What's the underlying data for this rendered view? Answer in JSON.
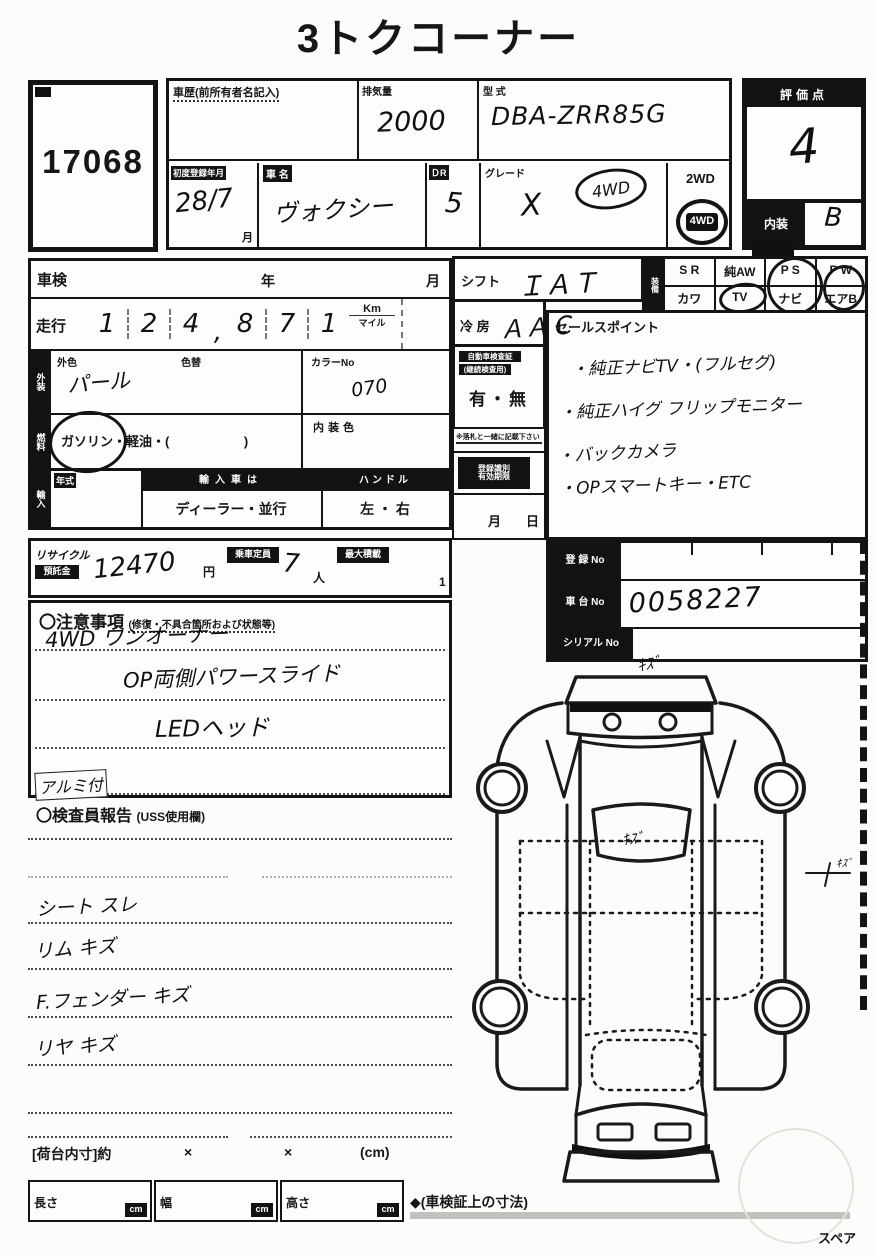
{
  "title": "3トクコーナー",
  "lot_number": "17068",
  "header": {
    "history_label": "車歴(前所有者名記入)",
    "disp_label": "排気量",
    "disp_value": "2000",
    "model_label": "型 式",
    "model_value": "DBA-ZRR85G",
    "reg_label": "初度登録年月",
    "reg_value": "28/7",
    "reg_unit": "月",
    "name_label": "車 名",
    "name_value": "ヴォクシー",
    "door_label": "ＤR",
    "door_value": "5",
    "grade_label": "グレード",
    "grade_value": "X",
    "grade_note": "4WD",
    "drive_2wd": "2WD",
    "drive_4wd": "4WD",
    "score_label": "評価点",
    "score_value": "4",
    "interior_label": "内装",
    "interior_value": "B"
  },
  "left": {
    "shaken": "車検",
    "year": "年",
    "month": "月",
    "mileage_label": "走行",
    "digits": [
      "1",
      "2",
      "4",
      ",",
      "8",
      "7",
      "1"
    ],
    "km": "Km",
    "mile": "マイル",
    "color_chip": "外装",
    "color_label": "外色",
    "color_value": "パール",
    "color_change": "色替",
    "colorno_label": "カラーNo",
    "colorno_value": "070",
    "fuel_chip": "燃料",
    "fuel_1": "ガソリン",
    "fuel_2": "・軽油・(",
    "fuel_3": ")",
    "intcolor_label": "内装色",
    "import_chip": "輸入",
    "year_label": "年式",
    "import_label": "輸入車は",
    "import_value": "ディーラー・並行",
    "handle_label": "ハンドル",
    "handle_value": "左 ・ 右"
  },
  "middle": {
    "shift_label": "シフト",
    "shift_value": "ＩＡＴ",
    "ac_label": "冷 房",
    "ac_value": "ＡＡＣ",
    "docs_chip1": "自動車検査証",
    "docs_chip2": "(継続検査用)",
    "docs_value": "有・無",
    "note": "※落札と一緒に記載下さい",
    "regbox1": "登録識別",
    "regbox2": "有効期限",
    "month": "月",
    "day": "日"
  },
  "equipment": {
    "side": "装備",
    "cols": [
      "S R",
      "純AW",
      "P S",
      "P W"
    ],
    "row2": [
      "カワ",
      "TV",
      "ナビ",
      "エアB"
    ]
  },
  "sales": {
    "label": "セールスポイント",
    "lines": [
      "・純正ナビTV・(フルセグ)",
      "・純正ハイグ フリップモニター",
      "・バックカメラ",
      "・OPスマートキー・ETC"
    ]
  },
  "reg": {
    "no_label": "登 録 No",
    "no_value": "",
    "chassis_label": "車 台 No",
    "chassis_value": "0058227",
    "serial_label": "シリアル No",
    "serial_value": ""
  },
  "recycle": {
    "l1": "リサイクル",
    "l2": "預託金",
    "value": "12470",
    "yen": "円",
    "cap_label": "乗車定員",
    "cap_value": "7",
    "cap_unit": "人",
    "load_label": "最大積載",
    "load_value": "1"
  },
  "notes": {
    "title": "〇注意事項",
    "subtitle": "(修復・不具合箇所および状態等)",
    "lines": [
      "4WD ワンオーナー",
      "OP両側パワースライド",
      "LEDヘッド",
      "アルミ付"
    ]
  },
  "inspector": {
    "title": "〇検査員報告",
    "subtitle": "(USS使用欄)",
    "lines": [
      "シート スレ",
      "リム キズ",
      "F.フェンダー キズ",
      "リヤ キズ"
    ]
  },
  "bottom": {
    "bed": "[荷台内寸]約",
    "x": "×",
    "cm_paren": "(cm)",
    "len": "長さ",
    "wid": "幅",
    "hei": "高さ",
    "cm": "cm",
    "note": "◆(車検証上の寸法)",
    "spare": "スペア"
  },
  "diagram": {
    "mark_front": "ｷｽﾞ",
    "mark_glass": "ｷｽﾞ",
    "mark_side": "ｷｽﾞ"
  }
}
